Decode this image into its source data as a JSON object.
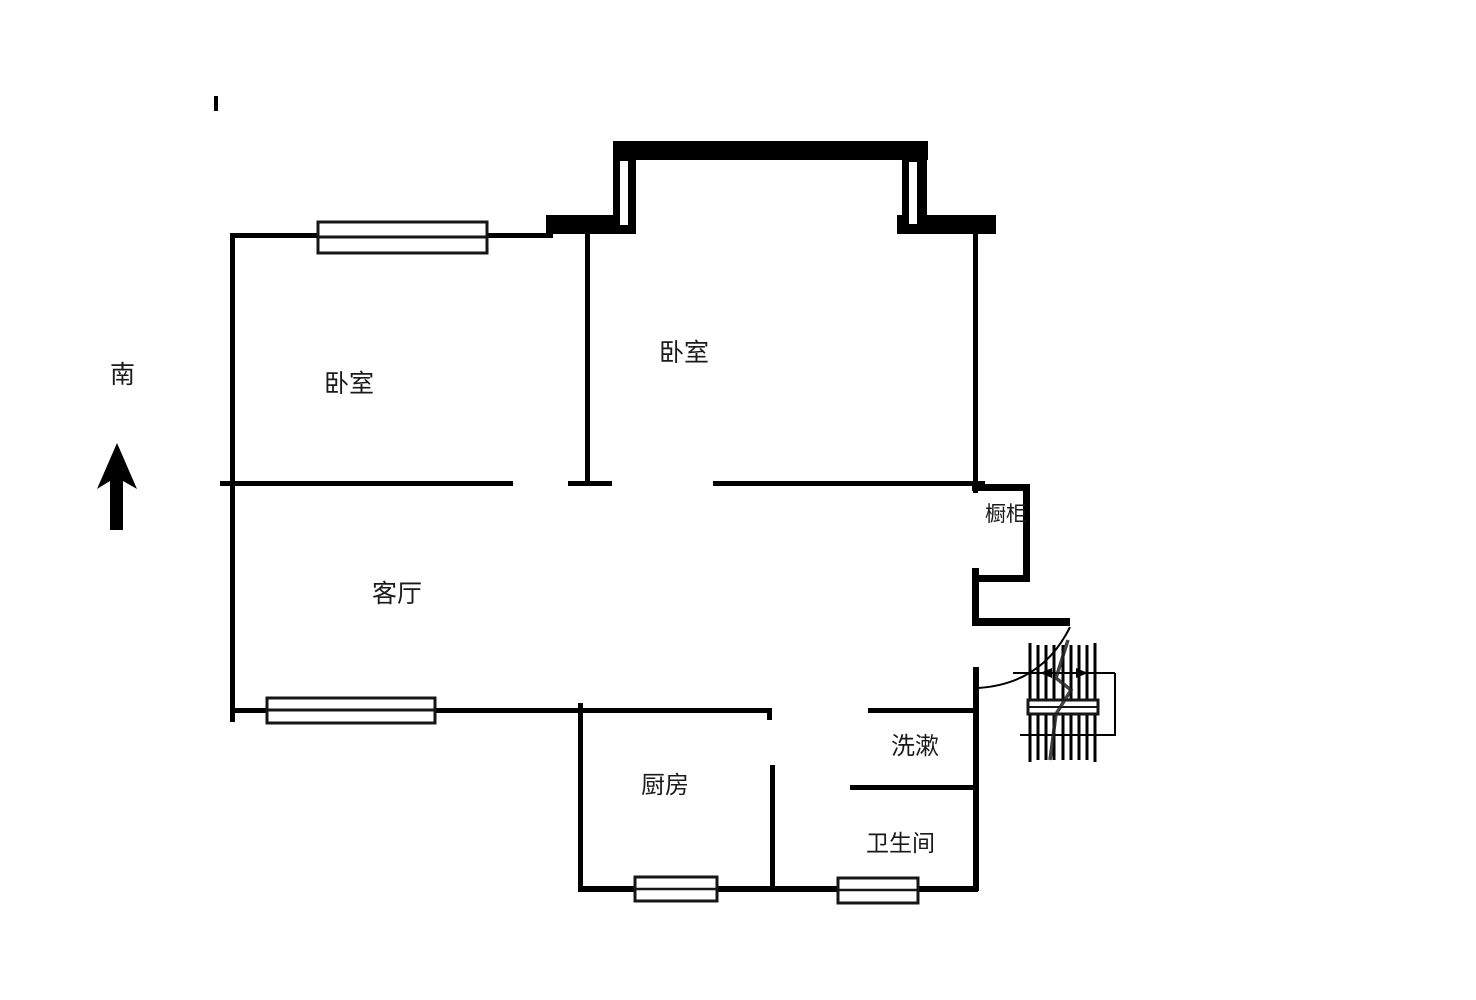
{
  "compass": {
    "label": "南",
    "icon": "north-arrow-icon"
  },
  "rooms": {
    "bedroom_left": {
      "label": "卧室"
    },
    "bedroom_right": {
      "label": "卧室"
    },
    "living_room": {
      "label": "客厅"
    },
    "cabinet": {
      "label": "橱柜"
    },
    "wash_area": {
      "label": "洗漱"
    },
    "kitchen": {
      "label": "厨房"
    },
    "bathroom": {
      "label": "卫生间"
    }
  },
  "icons": {
    "north-arrow-icon": "▲",
    "door-swing-icon": "arc",
    "staircase-icon": "hatched-lines",
    "window-icon": "double-rect"
  },
  "colors": {
    "wall": "#000000",
    "background": "#ffffff",
    "text": "#1a1a1a"
  }
}
